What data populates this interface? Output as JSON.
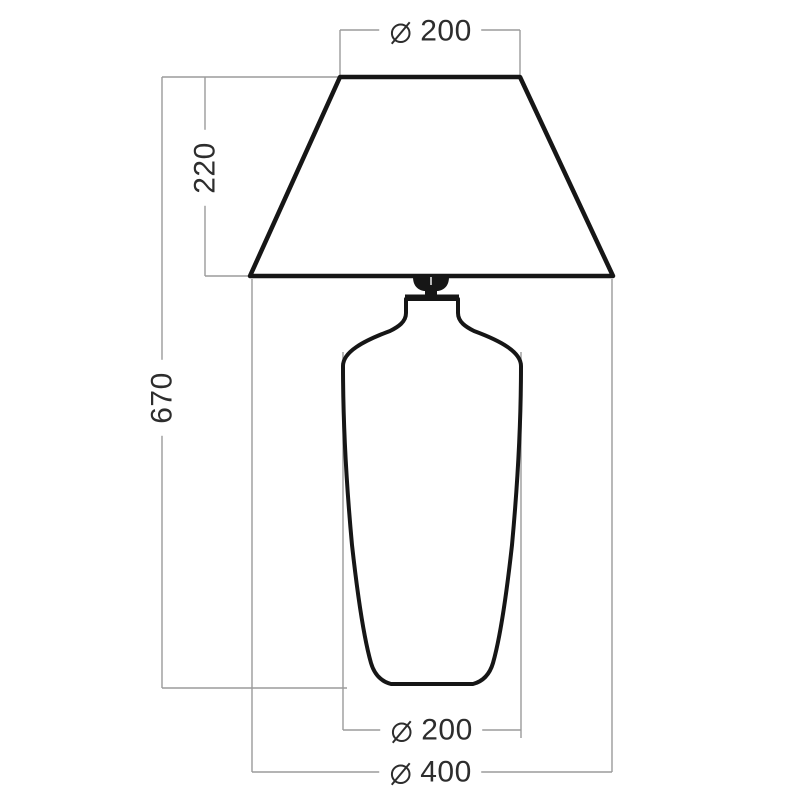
{
  "colors": {
    "background": "#ffffff",
    "lamp_outline": "#161616",
    "dimension_line": "#9b9b9b",
    "label_text": "#2d2d2d"
  },
  "icons": {
    "diameter": {
      "name": "diameter-icon",
      "glyph": "⌀"
    }
  },
  "dimensions": {
    "shade_top_diameter": {
      "symbol": "⌀",
      "value": "200"
    },
    "shade_height": {
      "value": "220"
    },
    "total_height": {
      "value": "670"
    },
    "body_max_diameter": {
      "symbol": "⌀",
      "value": "200"
    },
    "shade_bottom_diameter": {
      "symbol": "⌀",
      "value": "400"
    }
  }
}
